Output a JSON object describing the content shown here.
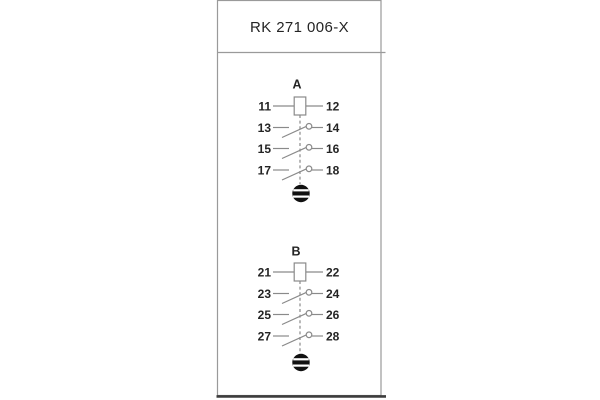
{
  "title": "RK 271 006-X",
  "sections": [
    {
      "label": "A",
      "rows": [
        {
          "left": "11",
          "right": "12",
          "symbol": "relay-coil"
        },
        {
          "left": "13",
          "right": "14",
          "symbol": "no-contact"
        },
        {
          "left": "15",
          "right": "16",
          "symbol": "no-contact"
        },
        {
          "left": "17",
          "right": "18",
          "symbol": "no-contact"
        }
      ],
      "footer_icon": "striped-circle-indicator"
    },
    {
      "label": "B",
      "rows": [
        {
          "left": "21",
          "right": "22",
          "symbol": "relay-coil"
        },
        {
          "left": "23",
          "right": "24",
          "symbol": "no-contact"
        },
        {
          "left": "25",
          "right": "26",
          "symbol": "no-contact"
        },
        {
          "left": "27",
          "right": "28",
          "symbol": "no-contact"
        }
      ],
      "footer_icon": "striped-circle-indicator"
    }
  ],
  "colors": {
    "line": "#8a8a8a",
    "text": "#242424",
    "border": "#9a9a9a",
    "bottom_edge": "#3d3d3d",
    "indicator_fill": "#111111"
  }
}
